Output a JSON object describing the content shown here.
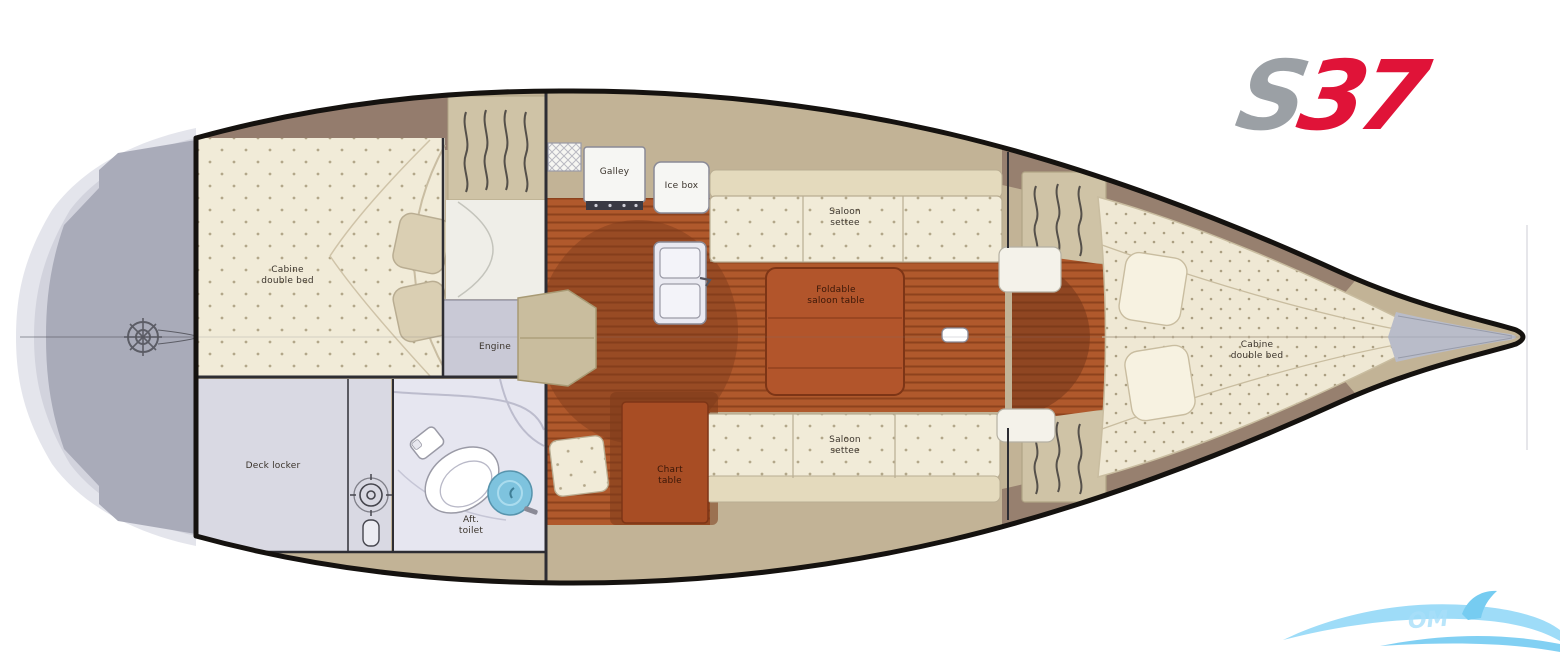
{
  "logo": {
    "gray_part": "S",
    "red_part": "37"
  },
  "labels": {
    "aft_cabin": "Cabine\ndouble bed",
    "engine": "Engine",
    "deck_locker": "Deck locker",
    "aft_toilet": "Aft.\ntoilet",
    "galley": "Galley",
    "ice_box": "Ice box",
    "saloon_settee_top": "Saloon\nsettee",
    "saloon_table": "Foldable\nsaloon table",
    "chart_table": "Chart\ntable",
    "saloon_settee_bottom": "Saloon\nsettee",
    "fwd_cabin": "Cabine\ndouble bed"
  },
  "watermark": {
    "text": "OM"
  },
  "colors": {
    "logo_gray": "#9ba0a5",
    "logo_red": "#e01338",
    "watermark_blue": "#8ed7f7",
    "hull_outline": "#15120f",
    "wood": "#b0592c",
    "wood_stripe": "#8d421d",
    "cushion_cream": "#f1ebd8",
    "wall_tan": "#c2b396",
    "deck_mauve": "#91796b",
    "wet_area": "#e4e4ef",
    "stern_gray": "#a9abb9",
    "table_rust": "#b2552b",
    "basin_blue": "#7ec3de"
  }
}
